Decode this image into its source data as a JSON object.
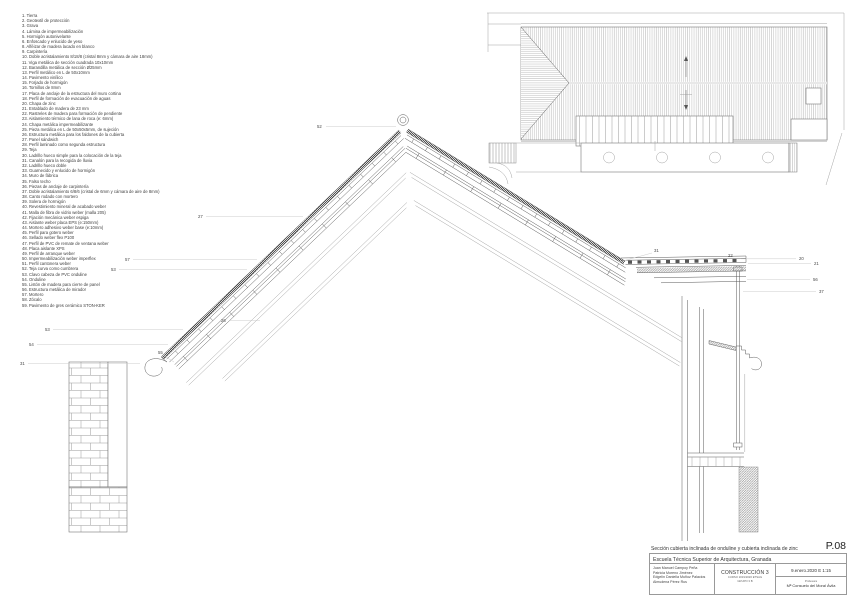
{
  "sheet": {
    "number": "P.08",
    "title": "Sección cubierta inclinada de onduline y cubierta inclinada de zinc",
    "school": "Escuela Técnica Superior de Arquitectura, Granada",
    "authors": [
      "Juan Manuel Campoy Peña",
      "Patricia Moreno Jiménez",
      "Edgelin Daniella Muñoz Palacios",
      "Almudena Pérez Rus"
    ],
    "course": "CONSTRUCCIÓN 3",
    "course_sub1": "CURSO 2019/2020 ETSAG",
    "course_sub2": "GRUPO 3 B",
    "date_scale": "9.enero.2020  E 1:15",
    "professor_label": "Profesora",
    "professor": "Mª Consuelo del Moral Ávila"
  },
  "legend": {
    "items": [
      {
        "n": "1",
        "t": "Tierra"
      },
      {
        "n": "2",
        "t": "Geotextil de protección"
      },
      {
        "n": "3",
        "t": "Grava"
      },
      {
        "n": "4",
        "t": "Lámina de impermeabilización"
      },
      {
        "n": "5",
        "t": "Hormigón autonivelante"
      },
      {
        "n": "6",
        "t": "Enfoscado y enlucido de yeso"
      },
      {
        "n": "8",
        "t": "Alféizar de madera lacado en blanco"
      },
      {
        "n": "9",
        "t": "Carpintería"
      },
      {
        "n": "10",
        "t": "Doble acristalamiento 8/18/8 (cristal 8mm y cámara de aire 18mm)"
      },
      {
        "n": "11",
        "t": "Viga metálica de sección cuadrada 10x10mm"
      },
      {
        "n": "12",
        "t": "Barandilla metálica de sección Ø25mm"
      },
      {
        "n": "13",
        "t": "Perfil metálico en L de 50x10mm"
      },
      {
        "n": "14",
        "t": "Pavimento vinílico"
      },
      {
        "n": "15",
        "t": "Forjado de hormigón"
      },
      {
        "n": "16",
        "t": "Tornillos de 8mm"
      },
      {
        "n": "17",
        "t": "Placa de anclaje de la estructura del muro cortina"
      },
      {
        "n": "18",
        "t": "Perfil de formación de evacuación de aguas"
      },
      {
        "n": "20",
        "t": "Chapa de zinc"
      },
      {
        "n": "21",
        "t": "Entablado de madera de 23 mm"
      },
      {
        "n": "22",
        "t": "Rastreles de madera para formación de pendiente"
      },
      {
        "n": "23",
        "t": "Aislamiento térmico de lana de roca (e: 6mm)"
      },
      {
        "n": "24",
        "t": "Chapa metálica impermeabilizante"
      },
      {
        "n": "25",
        "t": "Pieza metálica en L de 50x50x5mm, de sujeción"
      },
      {
        "n": "26",
        "t": "Estructura metálica para los faldones de la cubierta"
      },
      {
        "n": "27",
        "t": "Panel sándwich"
      },
      {
        "n": "28",
        "t": "Perfil laminado como segunda estructura"
      },
      {
        "n": "29",
        "t": "Teja"
      },
      {
        "n": "30",
        "t": "Ladrillo hueco simple para la colocación de la teja"
      },
      {
        "n": "31",
        "t": "Canalón para la recogida de lluvia"
      },
      {
        "n": "32",
        "t": "Ladrillo hueco doble"
      },
      {
        "n": "33",
        "t": "Guarnecido y enlucido de hormigón"
      },
      {
        "n": "34",
        "t": "Muro de fábrica"
      },
      {
        "n": "35",
        "t": "Falso techo"
      },
      {
        "n": "36",
        "t": "Piezas de anclaje de carpintería"
      },
      {
        "n": "37",
        "t": "Doble acristalamiento 6/8/6 (cristal de 6mm y cámara de aire de 8mm)"
      },
      {
        "n": "38",
        "t": "Canto rodado con mortero"
      },
      {
        "n": "39",
        "t": "Solera de hormigón"
      },
      {
        "n": "40",
        "t": "Revestimiento mineral de acabado weber"
      },
      {
        "n": "41",
        "t": "Malla de fibra de vidrio weber (malla 205)"
      },
      {
        "n": "42",
        "t": "Fijación mecánica weber espiga"
      },
      {
        "n": "43",
        "t": "Aislante weber placa EPS (e:150mm)"
      },
      {
        "n": "44",
        "t": "Mortero adhesivo weber base (e:10mm)"
      },
      {
        "n": "45",
        "t": "Perfil para gotero weber"
      },
      {
        "n": "46",
        "t": "Sellado weber flex P100"
      },
      {
        "n": "47",
        "t": "Perfil de PVC de remate de ventana weber"
      },
      {
        "n": "48",
        "t": "Placa aislante XPS"
      },
      {
        "n": "49",
        "t": "Perfil de arranque weber"
      },
      {
        "n": "50",
        "t": "Impermeabilización weber imperflex"
      },
      {
        "n": "51",
        "t": "Perfil cantonera weber"
      },
      {
        "n": "52",
        "t": "Teja curva como cumbrera"
      },
      {
        "n": "53",
        "t": "Clavo cabeza de PVC onduline"
      },
      {
        "n": "54",
        "t": "Onduline"
      },
      {
        "n": "55",
        "t": "Listón de madera para cierre de panel"
      },
      {
        "n": "56",
        "t": "Estructura metálica de mirador"
      },
      {
        "n": "57",
        "t": "Mortero"
      },
      {
        "n": "58",
        "t": "Zócalo"
      },
      {
        "n": "59",
        "t": "Pavimento de gres cerámico STON-KER"
      }
    ]
  },
  "callouts": [
    {
      "label": "52",
      "x": 317,
      "y": 128,
      "leader": [
        326,
        126.5,
        396,
        126.5
      ]
    },
    {
      "label": "27",
      "x": 198,
      "y": 218,
      "leader": [
        206,
        216.5,
        303,
        216.5
      ]
    },
    {
      "label": "57",
      "x": 125,
      "y": 261,
      "leader": [
        133,
        259.5,
        257,
        259.5
      ]
    },
    {
      "label": "53",
      "x": 111,
      "y": 271,
      "leader": [
        119,
        269.5,
        247,
        269.5
      ]
    },
    {
      "label": "53",
      "x": 45,
      "y": 331,
      "leader": [
        53,
        329.5,
        183,
        329.5
      ]
    },
    {
      "label": "54",
      "x": 29,
      "y": 346,
      "leader": [
        37,
        344.5,
        168,
        344.5
      ]
    },
    {
      "label": "31",
      "x": 20,
      "y": 365,
      "leader": [
        28,
        363.5,
        140,
        363.5
      ]
    },
    {
      "label": "55",
      "x": 158,
      "y": 354,
      "leader": [
        163,
        355,
        174,
        362
      ]
    },
    {
      "label": "26",
      "x": 221,
      "y": 322,
      "leader": [
        229,
        320.5,
        260,
        320.5
      ]
    },
    {
      "label": "31",
      "x": 654,
      "y": 252,
      "leader": [
        652,
        253,
        619,
        262
      ]
    },
    {
      "label": "22",
      "x": 728,
      "y": 257,
      "leader": null
    },
    {
      "label": "20",
      "x": 799,
      "y": 260,
      "leader": [
        741,
        258.8,
        796,
        258.8
      ]
    },
    {
      "label": "21",
      "x": 814,
      "y": 265,
      "leader": [
        748,
        263.5,
        811,
        263.5
      ]
    },
    {
      "label": "56",
      "x": 813,
      "y": 281,
      "leader": [
        747,
        279.5,
        810,
        279.5
      ]
    },
    {
      "label": "37",
      "x": 819,
      "y": 293,
      "leader": [
        743,
        291.5,
        816,
        291.5
      ]
    }
  ]
}
